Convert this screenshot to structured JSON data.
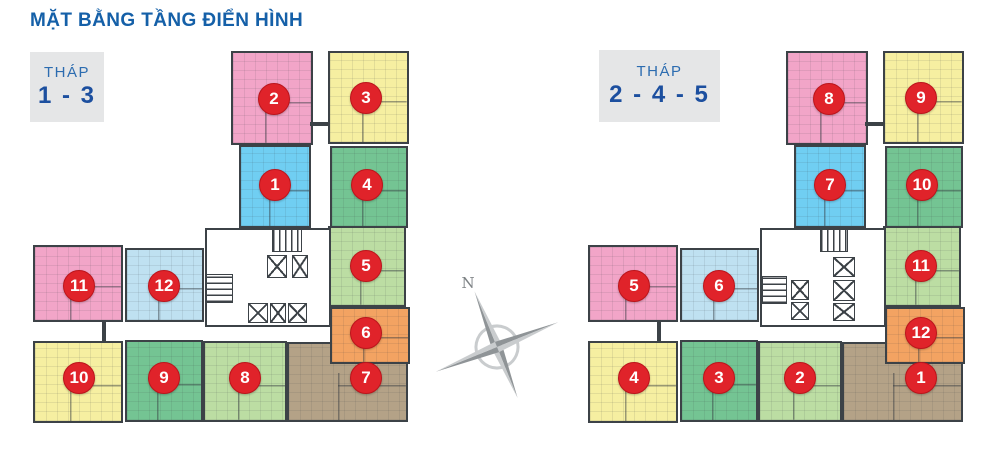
{
  "page": {
    "title": "MẶT BẰNG TẦNG ĐIỂN HÌNH",
    "compass_label": "N"
  },
  "tower_labels": [
    {
      "name": "THÁP",
      "numbers": "1 - 3"
    },
    {
      "name": "THÁP",
      "numbers": "2 - 4 - 5"
    }
  ],
  "colors": {
    "pink": "#F2A5C8",
    "yellow": "#F6EFA1",
    "blue": "#70CEF2",
    "light_blue": "#BFE1F1",
    "green": "#74C493",
    "light_green": "#BCDDA3",
    "orange": "#F3A362",
    "tan": "#B4A287",
    "wall": "#3C4247",
    "badge_bg": "#E0232A",
    "badge_border": "#BC141B",
    "badge_text": "#FFFFFF",
    "core_bg": "#FFFFFF",
    "compass_dark": "#8F9497",
    "compass_light": "#C9CCCE",
    "title_blue": "#1560A8",
    "label_number_blue": "#1C4F9F",
    "label_box_bg": "#E5E6E7"
  },
  "towers": [
    {
      "name": "thap-1-3",
      "units": [
        {
          "n": "2",
          "color": "pink",
          "x": 231,
          "y": 51,
          "w": 82,
          "h": 94,
          "bx": 274,
          "by": 99
        },
        {
          "n": "3",
          "color": "yellow",
          "x": 328,
          "y": 51,
          "w": 81,
          "h": 93,
          "bx": 366,
          "by": 98
        },
        {
          "n": "1",
          "color": "blue",
          "x": 239,
          "y": 145,
          "w": 72,
          "h": 83,
          "bx": 275,
          "by": 185
        },
        {
          "n": "4",
          "color": "green",
          "x": 330,
          "y": 146,
          "w": 78,
          "h": 82,
          "bx": 367,
          "by": 185
        },
        {
          "n": "5",
          "color": "light_green",
          "x": 328,
          "y": 226,
          "w": 78,
          "h": 81,
          "bx": 366,
          "by": 266
        },
        {
          "n": "7",
          "color": "tan",
          "x": 287,
          "y": 342,
          "w": 121,
          "h": 80,
          "bx": 366,
          "by": 378
        },
        {
          "n": "6",
          "color": "orange",
          "x": 330,
          "y": 307,
          "w": 80,
          "h": 57,
          "bx": 366,
          "by": 333
        },
        {
          "n": "11",
          "color": "pink",
          "x": 33,
          "y": 245,
          "w": 90,
          "h": 77,
          "bx": 79,
          "by": 286
        },
        {
          "n": "12",
          "color": "light_blue",
          "x": 125,
          "y": 248,
          "w": 79,
          "h": 74,
          "bx": 164,
          "by": 286
        },
        {
          "n": "10",
          "color": "yellow",
          "x": 33,
          "y": 341,
          "w": 90,
          "h": 82,
          "bx": 79,
          "by": 378
        },
        {
          "n": "9",
          "color": "green",
          "x": 125,
          "y": 340,
          "w": 78,
          "h": 82,
          "bx": 164,
          "by": 378
        },
        {
          "n": "8",
          "color": "light_green",
          "x": 203,
          "y": 341,
          "w": 84,
          "h": 81,
          "bx": 245,
          "by": 378
        }
      ],
      "core": {
        "x": 205,
        "y": 228,
        "w": 126,
        "h": 99
      },
      "stairs": [
        {
          "dir": "v",
          "x": 272,
          "y": 229,
          "w": 30,
          "h": 23
        },
        {
          "dir": "h",
          "x": 206,
          "y": 274,
          "w": 27,
          "h": 29
        }
      ],
      "elevators": [
        {
          "x": 267,
          "y": 255,
          "w": 20,
          "h": 23
        },
        {
          "x": 292,
          "y": 255,
          "w": 16,
          "h": 23
        },
        {
          "x": 248,
          "y": 303,
          "w": 20,
          "h": 20
        },
        {
          "x": 270,
          "y": 303,
          "w": 16,
          "h": 20
        },
        {
          "x": 288,
          "y": 303,
          "w": 19,
          "h": 20
        }
      ],
      "connectors": [
        {
          "x": 310,
          "y": 122,
          "w": 18,
          "h": 4
        },
        {
          "x": 102,
          "y": 322,
          "w": 4,
          "h": 19
        }
      ]
    },
    {
      "name": "thap-2-4-5",
      "units": [
        {
          "n": "8",
          "color": "pink",
          "x": 786,
          "y": 51,
          "w": 82,
          "h": 94,
          "bx": 829,
          "by": 99
        },
        {
          "n": "9",
          "color": "yellow",
          "x": 883,
          "y": 51,
          "w": 81,
          "h": 93,
          "bx": 921,
          "by": 98
        },
        {
          "n": "7",
          "color": "blue",
          "x": 794,
          "y": 145,
          "w": 72,
          "h": 83,
          "bx": 830,
          "by": 185
        },
        {
          "n": "10",
          "color": "green",
          "x": 885,
          "y": 146,
          "w": 78,
          "h": 82,
          "bx": 922,
          "by": 185
        },
        {
          "n": "11",
          "color": "light_green",
          "x": 883,
          "y": 226,
          "w": 78,
          "h": 81,
          "bx": 921,
          "by": 266
        },
        {
          "n": "1",
          "color": "tan",
          "x": 842,
          "y": 342,
          "w": 121,
          "h": 80,
          "bx": 921,
          "by": 378
        },
        {
          "n": "12",
          "color": "orange",
          "x": 885,
          "y": 307,
          "w": 80,
          "h": 57,
          "bx": 921,
          "by": 333
        },
        {
          "n": "5",
          "color": "pink",
          "x": 588,
          "y": 245,
          "w": 90,
          "h": 77,
          "bx": 634,
          "by": 286
        },
        {
          "n": "6",
          "color": "light_blue",
          "x": 680,
          "y": 248,
          "w": 79,
          "h": 74,
          "bx": 719,
          "by": 286
        },
        {
          "n": "4",
          "color": "yellow",
          "x": 588,
          "y": 341,
          "w": 90,
          "h": 82,
          "bx": 634,
          "by": 378
        },
        {
          "n": "3",
          "color": "green",
          "x": 680,
          "y": 340,
          "w": 78,
          "h": 82,
          "bx": 719,
          "by": 378
        },
        {
          "n": "2",
          "color": "light_green",
          "x": 758,
          "y": 341,
          "w": 84,
          "h": 81,
          "bx": 800,
          "by": 378
        }
      ],
      "core": {
        "x": 760,
        "y": 228,
        "w": 126,
        "h": 99
      },
      "stairs": [
        {
          "dir": "v",
          "x": 820,
          "y": 229,
          "w": 28,
          "h": 23
        },
        {
          "dir": "h",
          "x": 762,
          "y": 276,
          "w": 25,
          "h": 28
        }
      ],
      "elevators": [
        {
          "x": 791,
          "y": 280,
          "w": 18,
          "h": 20
        },
        {
          "x": 791,
          "y": 302,
          "w": 18,
          "h": 18
        },
        {
          "x": 833,
          "y": 257,
          "w": 22,
          "h": 20
        },
        {
          "x": 833,
          "y": 280,
          "w": 22,
          "h": 21
        },
        {
          "x": 833,
          "y": 303,
          "w": 22,
          "h": 18
        }
      ],
      "connectors": [
        {
          "x": 865,
          "y": 122,
          "w": 18,
          "h": 4
        },
        {
          "x": 657,
          "y": 322,
          "w": 4,
          "h": 19
        }
      ]
    }
  ],
  "compass": {
    "x": 435,
    "y": 272,
    "w": 130,
    "h": 148
  }
}
